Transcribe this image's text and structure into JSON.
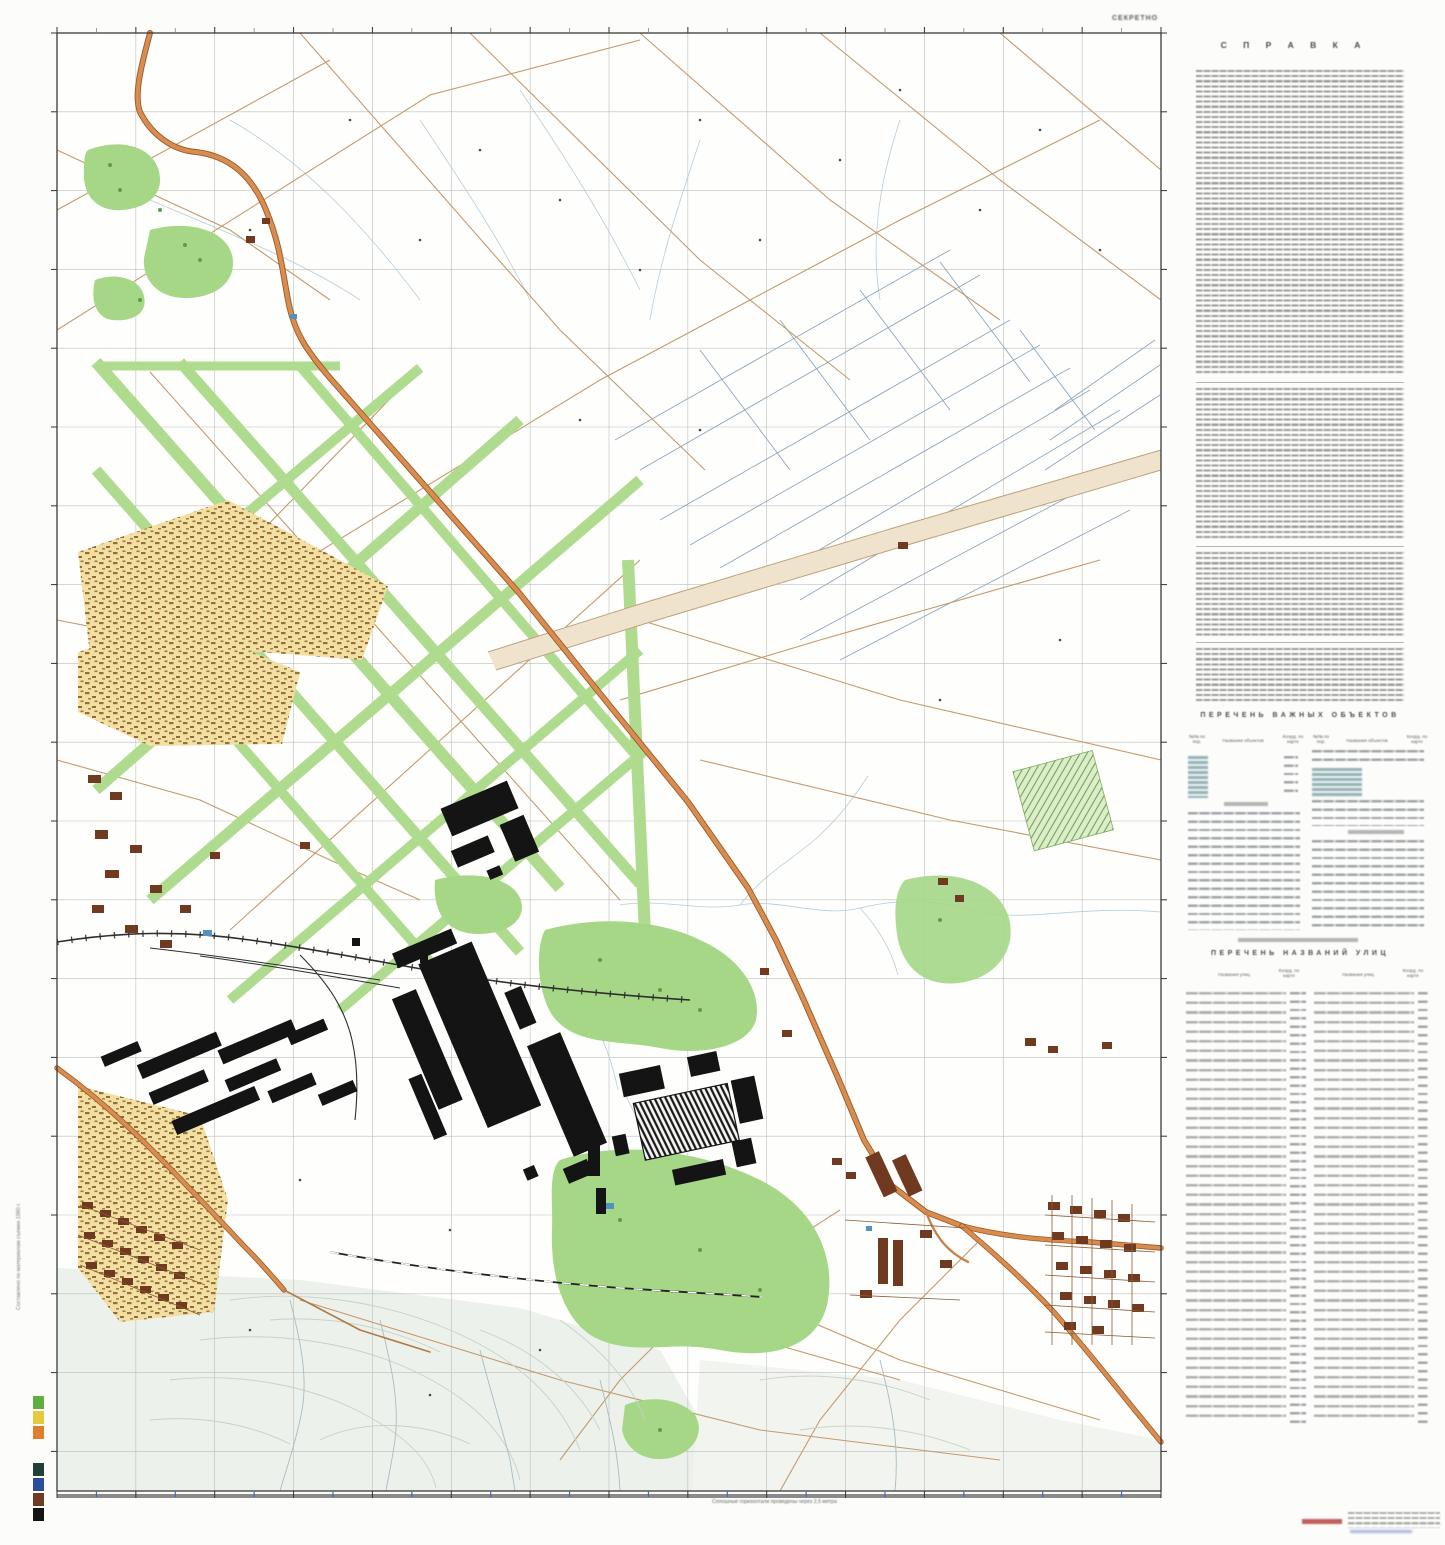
{
  "classification": "СЕКРЕТНО",
  "sidebar": {
    "title": "С П Р А В К А",
    "objects": {
      "title": "ПЕРЕЧЕНЬ ВАЖНЫХ ОБЪЕКТОВ",
      "col_num": "№№ по пор.",
      "col_name": "Названия объектов",
      "col_coord": "Коорд. по карте"
    },
    "streets": {
      "title": "ПЕРЕЧЕНЬ НАЗВАНИЙ УЛИЦ",
      "col_name": "Названия улиц",
      "col_coord": "Коорд. по карте"
    }
  },
  "footer": {
    "contour_note": "Сплошные горизонтали проведены через 2,5 метра"
  },
  "left_margin": {
    "note": "Составлено по материалам съемки 1980 г."
  },
  "color_bar": [
    "#5fae3f",
    "#e5c93f",
    "#df7f2e",
    "#224038",
    "#2c4d9e",
    "#6e3a20",
    "#141414"
  ]
}
